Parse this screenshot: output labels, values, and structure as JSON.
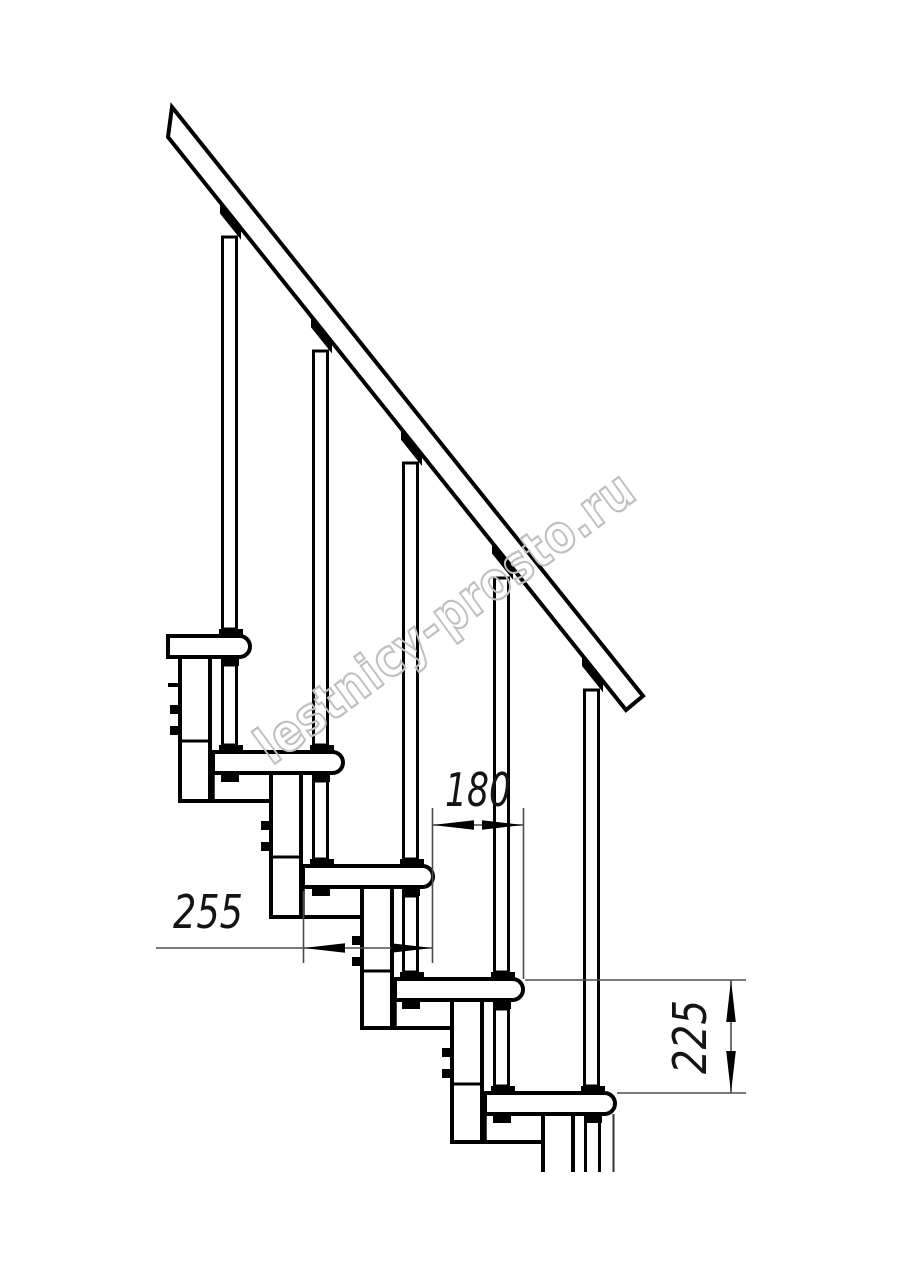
{
  "watermark": {
    "text": "lestnicy-prosto.ru",
    "color": "#bfbfbf"
  },
  "dimensions": {
    "run": {
      "value": "180",
      "orientation": "horizontal"
    },
    "depth": {
      "value": "255",
      "orientation": "horizontal"
    },
    "rise": {
      "value": "225",
      "orientation": "vertical"
    }
  },
  "colors": {
    "background": "#ffffff",
    "line": "#000000",
    "dimension_line": "#4d4d4d",
    "dimension_text": "#141414"
  }
}
